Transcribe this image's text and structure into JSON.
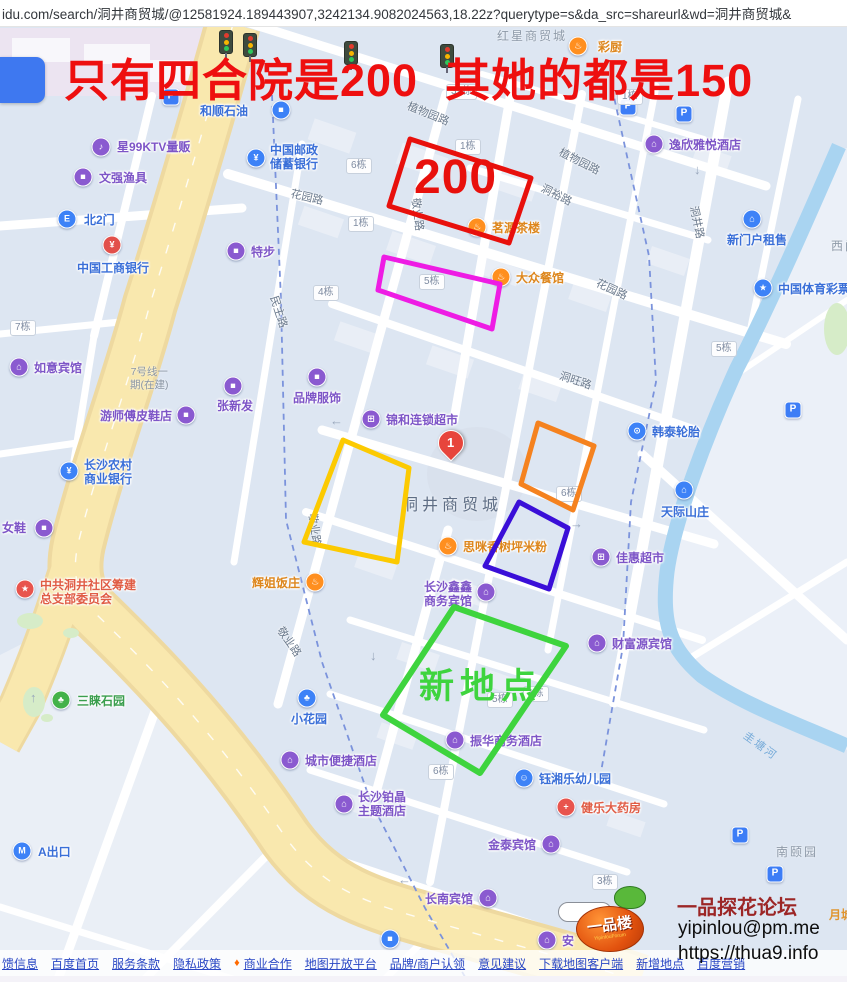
{
  "url_bar": {
    "url": "idu.com/search/洞井商贸城/@12581924.189443907,3242134.9082024563,18.22z?querytype=s&da_src=shareurl&wd=洞井商贸城&"
  },
  "caption": {
    "text": "只有四合院是200  其她的都是150",
    "color": "#ee0f0f"
  },
  "annotations": {
    "rects": [
      {
        "name": "red-rect",
        "points": "410,139 531,178 509,243 389,206",
        "color": "#e8100c",
        "width": 5
      },
      {
        "name": "magenta-rect",
        "points": "384,257 500,284 492,329 378,290",
        "color": "#ee1ce4",
        "width": 5
      },
      {
        "name": "yellow-rect",
        "points": "343,440 409,468 397,562 304,542",
        "color": "#fcca01",
        "width": 5
      },
      {
        "name": "orange-rect",
        "points": "538,423 594,446 573,510 521,484",
        "color": "#f5821f",
        "width": 5
      },
      {
        "name": "blue-rect",
        "points": "519,502 568,528 549,589 485,566",
        "color": "#3a0fd8",
        "width": 5
      },
      {
        "name": "green-rect",
        "points": "454,607 566,646 480,773 383,715",
        "color": "#3ed43e",
        "width": 6
      }
    ],
    "price_label": {
      "text": "200",
      "color": "#e8100c",
      "x": 414,
      "y": 150
    },
    "new_place_label": {
      "text": "新地点",
      "color": "#3ed43e",
      "x": 419,
      "y": 658
    }
  },
  "map": {
    "marker": {
      "label": "1"
    },
    "pois": [
      {
        "t": "和顺石油",
        "tx": 200,
        "ty": 104,
        "c": "blue",
        "g": "■",
        "ix": 281,
        "iy": 110
      },
      {
        "t": "星99KTV量贩",
        "tx": 117,
        "ty": 140,
        "c": "purple",
        "g": "♪",
        "ix": 101,
        "iy": 147
      },
      {
        "t": "文强渔具",
        "tx": 99,
        "ty": 171,
        "c": "purple",
        "g": "■",
        "ix": 83,
        "iy": 177
      },
      {
        "t": "北2门",
        "tx": 84,
        "ty": 213,
        "c": "blue",
        "g": "E",
        "ix": 67,
        "iy": 219
      },
      {
        "t": "中国工商银行",
        "tx": 77,
        "ty": 261,
        "c": "blue",
        "g": "¥",
        "ix": 112,
        "iy": 245,
        "ic": "#e2504b"
      },
      {
        "t": "中国邮政",
        "t2": "储蓄银行",
        "tx": 270,
        "ty": 143,
        "c": "blue",
        "g": "¥",
        "ix": 256,
        "iy": 158
      },
      {
        "t": "特步",
        "tx": 251,
        "ty": 245,
        "c": "purple",
        "g": "■",
        "ix": 236,
        "iy": 251
      },
      {
        "t": "彩厨",
        "tx": 598,
        "ty": 40,
        "c": "orange",
        "g": "♨",
        "ix": 578,
        "iy": 46
      },
      {
        "t": "逸欣雅悦酒店",
        "tx": 669,
        "ty": 138,
        "c": "purple",
        "g": "⌂",
        "ix": 654,
        "iy": 144
      },
      {
        "t": "新门户租售",
        "tx": 727,
        "ty": 233,
        "c": "blue",
        "g": "⌂",
        "ix": 752,
        "iy": 219
      },
      {
        "t": "中国体育彩票",
        "tx": 778,
        "ty": 282,
        "c": "blue",
        "g": "★",
        "ix": 763,
        "iy": 288
      },
      {
        "t": "茗源茶楼",
        "tx": 492,
        "ty": 221,
        "c": "orange",
        "g": "♨",
        "ix": 477,
        "iy": 227
      },
      {
        "t": "大众餐馆",
        "tx": 516,
        "ty": 271,
        "c": "orange",
        "g": "♨",
        "ix": 501,
        "iy": 277
      },
      {
        "t": "如意宾馆",
        "tx": 34,
        "ty": 361,
        "c": "purple",
        "g": "⌂",
        "ix": 19,
        "iy": 367
      },
      {
        "t": "张新发",
        "tx": 217,
        "ty": 399,
        "c": "purple",
        "g": "■",
        "ix": 233,
        "iy": 386
      },
      {
        "t": "游师傅皮鞋店",
        "tx": 100,
        "ty": 409,
        "c": "purple",
        "g": "■",
        "ix": 186,
        "iy": 415
      },
      {
        "t": "长沙农村",
        "t2": "商业银行",
        "tx": 84,
        "ty": 458,
        "c": "blue",
        "g": "¥",
        "ix": 69,
        "iy": 471
      },
      {
        "t": "女鞋",
        "tx": 2,
        "ty": 521,
        "c": "purple",
        "g": "■",
        "ix": 44,
        "iy": 528
      },
      {
        "t": "品牌服饰",
        "tx": 293,
        "ty": 391,
        "c": "purple",
        "g": "■",
        "ix": 317,
        "iy": 377
      },
      {
        "t": "锦和连锁超市",
        "tx": 386,
        "ty": 413,
        "c": "purple",
        "g": "⊞",
        "ix": 371,
        "iy": 419
      },
      {
        "t": "韩泰轮胎",
        "tx": 652,
        "ty": 425,
        "c": "blue",
        "g": "⊙",
        "ix": 637,
        "iy": 431
      },
      {
        "t": "思咪香树坪米粉",
        "tx": 463,
        "ty": 540,
        "c": "orange",
        "g": "♨",
        "ix": 448,
        "iy": 546
      },
      {
        "t": "佳惠超市",
        "tx": 616,
        "ty": 551,
        "c": "purple",
        "g": "⊞",
        "ix": 601,
        "iy": 557
      },
      {
        "t": "天际山庄",
        "tx": 661,
        "ty": 505,
        "c": "blue",
        "g": "⌂",
        "ix": 684,
        "iy": 490
      },
      {
        "t": "长沙鑫鑫",
        "t2": "商务宾馆",
        "tx": 424,
        "ty": 580,
        "c": "purple",
        "g": "⌂",
        "ix": 486,
        "iy": 592
      },
      {
        "t": "辉姐饭庄",
        "tx": 252,
        "ty": 576,
        "c": "orange",
        "g": "♨",
        "ix": 315,
        "iy": 582
      },
      {
        "t": "财富源宾馆",
        "tx": 612,
        "ty": 637,
        "c": "purple",
        "g": "⌂",
        "ix": 597,
        "iy": 643
      },
      {
        "t": "中共洞井社区筹建",
        "t2": "总支部委员会",
        "tx": 40,
        "ty": 578,
        "c": "red",
        "g": "★",
        "ix": 25,
        "iy": 589
      },
      {
        "t": "三睐石园",
        "tx": 77,
        "ty": 694,
        "c": "green",
        "g": "♣",
        "ix": 61,
        "iy": 700
      },
      {
        "t": "小花园",
        "tx": 291,
        "ty": 712,
        "c": "blue",
        "g": "♣",
        "ix": 307,
        "iy": 698
      },
      {
        "t": "振华商务酒店",
        "tx": 470,
        "ty": 734,
        "c": "purple",
        "g": "⌂",
        "ix": 455,
        "iy": 740
      },
      {
        "t": "城市便捷酒店",
        "tx": 305,
        "ty": 754,
        "c": "purple",
        "g": "⌂",
        "ix": 290,
        "iy": 760
      },
      {
        "t": "钰湘乐幼儿园",
        "tx": 539,
        "ty": 772,
        "c": "blue",
        "g": "☺",
        "ix": 524,
        "iy": 778
      },
      {
        "t": "长沙铂晶",
        "t2": "主题酒店",
        "tx": 358,
        "ty": 790,
        "c": "purple",
        "g": "⌂",
        "ix": 344,
        "iy": 804
      },
      {
        "t": "健乐大药房",
        "tx": 581,
        "ty": 801,
        "c": "red",
        "g": "+",
        "ix": 566,
        "iy": 807
      },
      {
        "t": "金泰宾馆",
        "tx": 488,
        "ty": 838,
        "c": "purple",
        "g": "⌂",
        "ix": 551,
        "iy": 844
      },
      {
        "t": "长南宾馆",
        "tx": 425,
        "ty": 892,
        "c": "purple",
        "g": "⌂",
        "ix": 488,
        "iy": 898
      },
      {
        "t": "安",
        "tx": 562,
        "ty": 934,
        "c": "purple",
        "g": "⌂",
        "ix": 547,
        "iy": 940
      },
      {
        "t": "A出口",
        "tx": 38,
        "ty": 845,
        "c": "blue",
        "g": "M",
        "ix": 22,
        "iy": 851
      },
      {
        "t": "",
        "tx": 0,
        "ty": 0,
        "c": "blue",
        "g": "■",
        "ix": 390,
        "iy": 939
      }
    ],
    "roads": [
      {
        "t": "植物园路",
        "x": 408,
        "y": 97,
        "r": 22
      },
      {
        "t": "植物园路",
        "x": 560,
        "y": 143,
        "r": 27
      },
      {
        "t": "花园路",
        "x": 291,
        "y": 185,
        "r": 13
      },
      {
        "t": "花园路",
        "x": 597,
        "y": 274,
        "r": 25
      },
      {
        "t": "洞裕路",
        "x": 542,
        "y": 179,
        "r": 27
      },
      {
        "t": "洞井路",
        "x": 694,
        "y": 198,
        "r": 78
      },
      {
        "t": "洞旺路",
        "x": 560,
        "y": 367,
        "r": 18
      },
      {
        "t": "民主路",
        "x": 274,
        "y": 288,
        "r": 72
      },
      {
        "t": "敬业路",
        "x": 416,
        "y": 190,
        "r": 83
      },
      {
        "t": "敬业路",
        "x": 313,
        "y": 505,
        "r": 83
      },
      {
        "t": "敬业路",
        "x": 280,
        "y": 620,
        "r": 55
      }
    ],
    "areas": [
      {
        "t": "红星商贸城",
        "x": 497,
        "y": 27,
        "cls": "area"
      },
      {
        "t": "洞井商贸城",
        "x": 402,
        "y": 491,
        "cls": "area-big"
      },
      {
        "t": "南颐园",
        "x": 776,
        "y": 843,
        "cls": "area"
      },
      {
        "t": "西门",
        "x": 831,
        "y": 237,
        "cls": "area"
      },
      {
        "t": "月城",
        "x": 829,
        "y": 906,
        "cls": "orange-l"
      },
      {
        "t": "圭塘河",
        "x": 745,
        "y": 726,
        "cls": "water-l",
        "r": 36
      },
      {
        "t": "7号线一",
        "t2": "期(在建)",
        "x": 130,
        "y": 366,
        "cls": "metro-l"
      }
    ],
    "buildings": [
      {
        "t": "39栋",
        "x": 446,
        "y": 84
      },
      {
        "t": "1栋",
        "x": 617,
        "y": 89
      },
      {
        "t": "1栋",
        "x": 455,
        "y": 139
      },
      {
        "t": "6栋",
        "x": 346,
        "y": 158
      },
      {
        "t": "1栋",
        "x": 348,
        "y": 216
      },
      {
        "t": "5栋",
        "x": 419,
        "y": 274
      },
      {
        "t": "4栋",
        "x": 313,
        "y": 285
      },
      {
        "t": "7栋",
        "x": 10,
        "y": 320
      },
      {
        "t": "5栋",
        "x": 711,
        "y": 341
      },
      {
        "t": "6栋",
        "x": 556,
        "y": 486
      },
      {
        "t": "1栋",
        "x": 523,
        "y": 686
      },
      {
        "t": "5栋",
        "x": 487,
        "y": 692
      },
      {
        "t": "6栋",
        "x": 428,
        "y": 764
      },
      {
        "t": "3栋",
        "x": 592,
        "y": 874
      }
    ],
    "parking": [
      {
        "x": 171,
        "y": 97
      },
      {
        "x": 628,
        "y": 107
      },
      {
        "x": 684,
        "y": 114
      },
      {
        "x": 793,
        "y": 410
      },
      {
        "x": 740,
        "y": 835
      },
      {
        "x": 775,
        "y": 874
      }
    ],
    "traffic_lights": [
      {
        "x": 219,
        "y": 30
      },
      {
        "x": 243,
        "y": 33
      },
      {
        "x": 344,
        "y": 41
      },
      {
        "x": 440,
        "y": 44
      }
    ],
    "arrows": [
      {
        "t": "↓",
        "x": 694,
        "y": 162
      },
      {
        "t": "↑",
        "x": 30,
        "y": 690
      },
      {
        "t": "↓",
        "x": 370,
        "y": 648
      },
      {
        "t": "→",
        "x": 570,
        "y": 516
      },
      {
        "t": "←",
        "x": 330,
        "y": 413
      },
      {
        "t": "←",
        "x": 398,
        "y": 872
      }
    ]
  },
  "watermark": {
    "title": "一品探花论坛",
    "email": "yipinlou@pm.me",
    "site": "https://thua9.info",
    "logo": "一品楼",
    "logo_sub": "YipinlouForum"
  },
  "footer": {
    "links": [
      "馈信息",
      "百度首页",
      "服务条款",
      "隐私政策",
      "商业合作",
      "地图开放平台",
      "品牌/商户认领",
      "意见建议",
      "下载地图客户端",
      "新增地点",
      "百度营销"
    ]
  },
  "colors": {
    "poi_purple": "#8a5ad0",
    "poi_blue": "#3d82f7",
    "poi_orange": "#ff8f1f",
    "poi_red": "#e8544d",
    "poi_green": "#43b249",
    "avenue_yellow": "#f9e8ae",
    "river_blue": "#a9d4f1",
    "block_fill": "#dde6f2"
  }
}
